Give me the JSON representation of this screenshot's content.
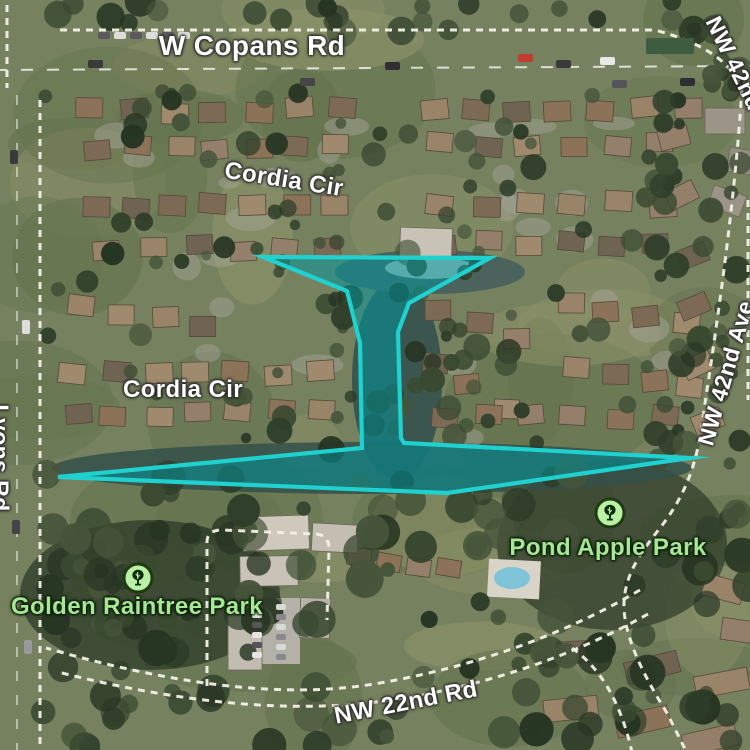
{
  "map": {
    "view": "satellite",
    "road_labels": {
      "w_copans_rd": "W Copans Rd",
      "cordia_cir_upper": "Cordia Cir",
      "cordia_cir_lower": "Cordia Cir",
      "nw_42nd_ave": "NW 42nd Ave",
      "nw_42nd_ave_fragment": "NW 42nd Ave",
      "lyons_rd": "Lyons Rd",
      "nw_22nd_rd": "NW 22nd Rd"
    },
    "parks": {
      "pond_apple": {
        "name": "Pond Apple Park",
        "icon": "tree-icon"
      },
      "golden_raintree": {
        "name": "Golden Raintree Park",
        "icon": "tree-icon"
      }
    },
    "label_colors": {
      "road_text": "#ffffff",
      "park_text": "#a7e794"
    },
    "selection": {
      "stroke": "#1fd2d0",
      "fill": "rgba(0,152,160,0.52)",
      "stroke_width": 4.2,
      "points": [
        [
          263,
          257
        ],
        [
          490,
          258
        ],
        [
          409,
          303
        ],
        [
          398,
          332
        ],
        [
          401,
          438
        ],
        [
          404,
          443
        ],
        [
          690,
          458
        ],
        [
          447,
          493
        ],
        [
          58,
          477
        ],
        [
          362,
          448
        ],
        [
          360,
          343
        ],
        [
          347,
          291
        ]
      ]
    }
  }
}
